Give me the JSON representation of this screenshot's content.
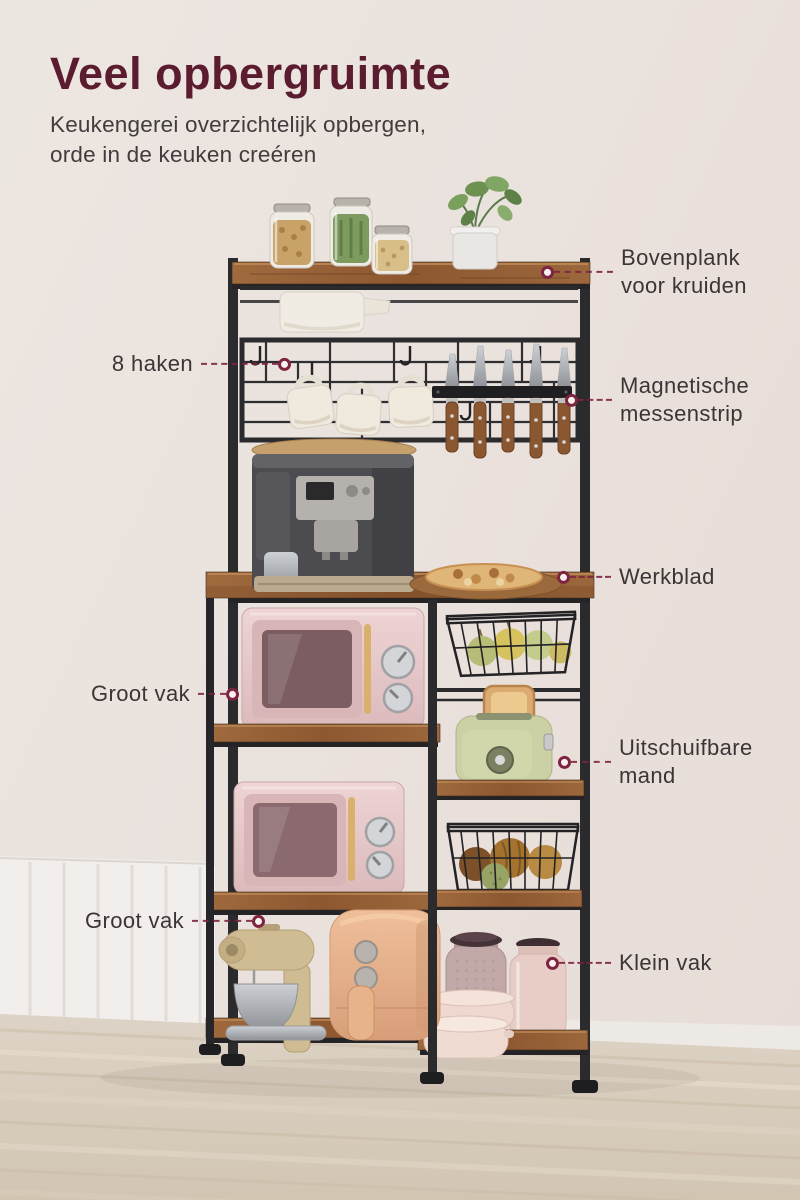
{
  "header": {
    "title": "Veel opbergruimte",
    "subtitle": "Keukengerei overzichtelijk opbergen,\norde in de keuken creéren"
  },
  "callouts": {
    "bovenplank": "Bovenplank\nvoor kruiden",
    "haken": "8 haken",
    "messenstrip": "Magnetische\nmessenstrip",
    "werkblad": "Werkblad",
    "groot_vak_boven": "Groot vak",
    "mand": "Uitschuifbare\nmand",
    "groot_vak_onder": "Groot vak",
    "klein_vak": "Klein vak"
  },
  "colors": {
    "title": "#5B1C30",
    "connector": "#7E2340",
    "label_text": "#3B3537",
    "wood": "#96613A",
    "frame": "#2B2A2D",
    "wall": "#EAE2DD",
    "floor": "#D8CDBE"
  },
  "scene": {
    "items": [
      "spice-jars",
      "potted-plant",
      "paper-towel-roll",
      "hook-grid",
      "mugs",
      "magnetic-knife-strip-with-knives",
      "coffee-machine",
      "bread-board",
      "pink-microwave-top",
      "pink-microwave-bottom",
      "wire-fruit-basket-top",
      "toaster-with-bread",
      "wire-fruit-basket-bottom",
      "stand-mixer",
      "air-fryer",
      "storage-jars",
      "stacked-bowls"
    ]
  }
}
